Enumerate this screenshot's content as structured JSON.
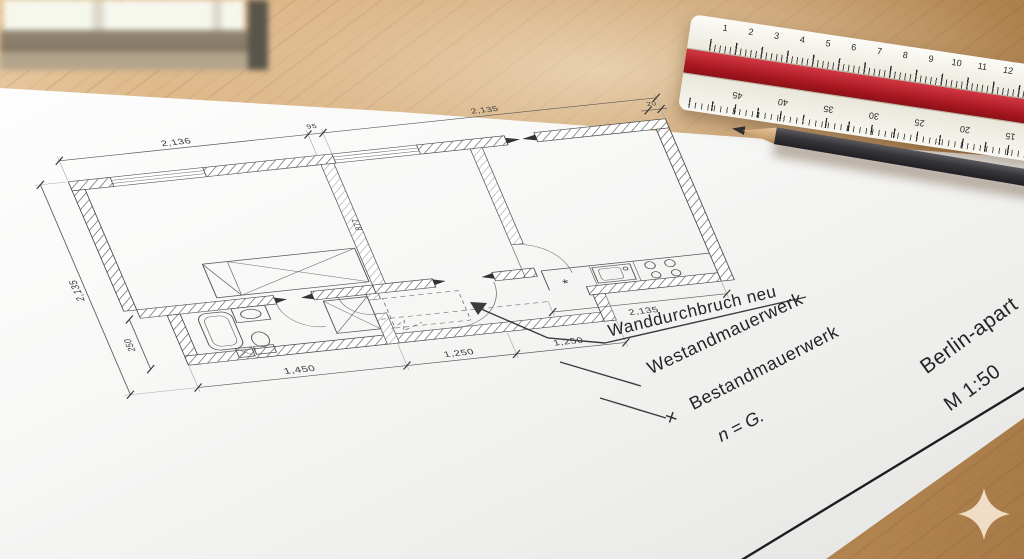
{
  "photo": {
    "plan": {
      "dimensions": {
        "top_main": "2,136",
        "top_pier": "95",
        "top_right": "2,135",
        "left_height": "2,135",
        "bath_height": "250",
        "bottom": [
          "1,450",
          "1,250",
          "1,250"
        ],
        "kitchen_width": "2,135",
        "wall_thickness": "20",
        "interior_faint": "877",
        "stove_symbol": "*"
      },
      "legend": {
        "items": [
          "Wanddurchbruch neu",
          "Westandmauerwerk",
          "Bestandmauerwerk",
          "n = G."
        ],
        "strike_symbol": "✕"
      },
      "title_block": {
        "project": "Berlin-apart",
        "scale": "M 1:50"
      }
    },
    "ruler": {
      "top_numbers": [
        "1",
        "2",
        "3",
        "4",
        "5",
        "6",
        "7",
        "8",
        "9",
        "10",
        "11",
        "12"
      ],
      "bottom_numbers": [
        "15",
        "20",
        "25",
        "30",
        "35",
        "40",
        "45"
      ],
      "red_color": "#a5161f"
    },
    "colors": {
      "desk": "#c4955f",
      "paper": "#f7f7f6",
      "pencil": "#35353a"
    }
  }
}
